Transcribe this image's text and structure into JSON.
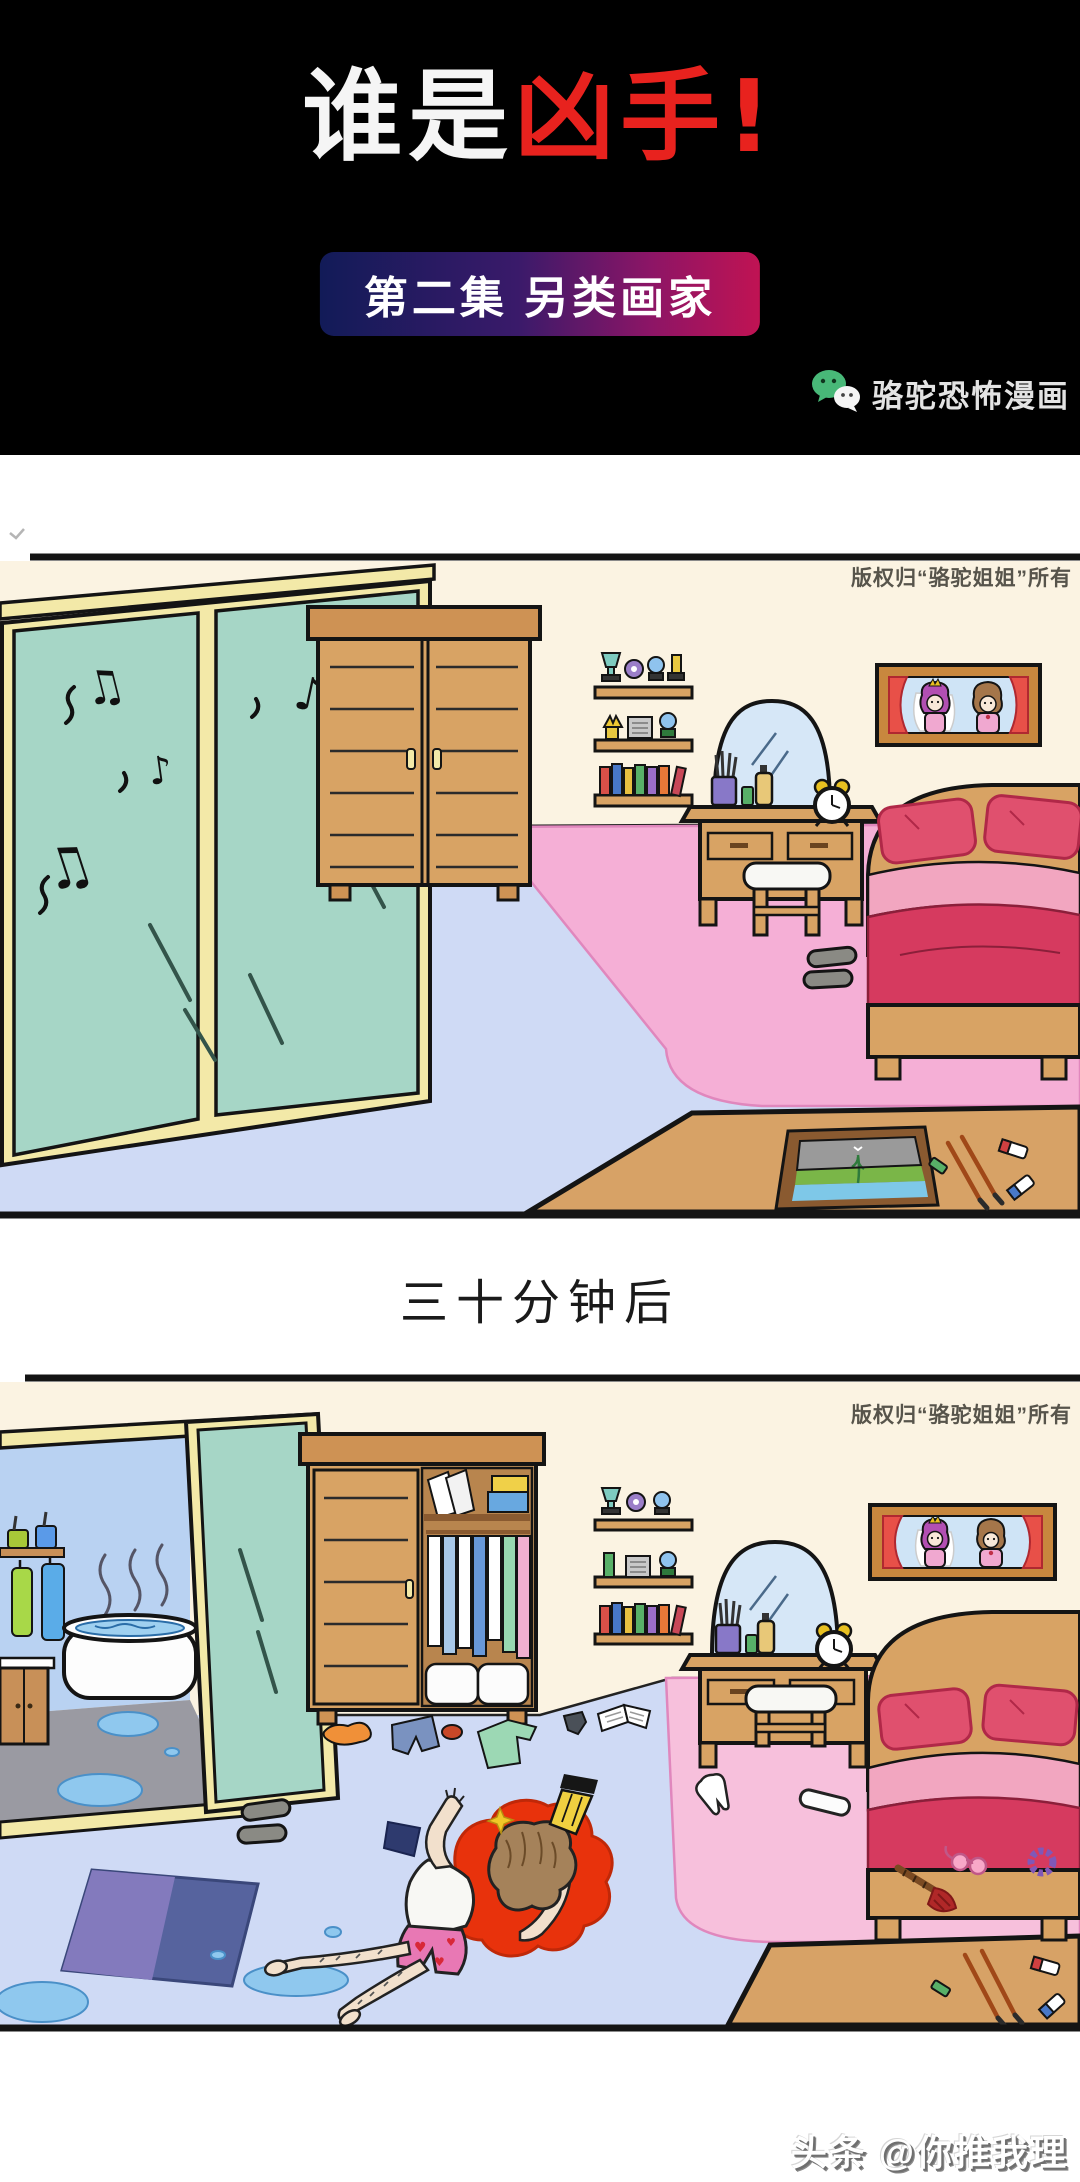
{
  "header": {
    "title": {
      "white_part": "谁是",
      "red_part": "凶手!"
    },
    "episode_banner": {
      "label": "第二集 另类画家"
    },
    "publisher": {
      "label": "骆驼恐怖漫画",
      "icon": "wechat-icon"
    },
    "colors": {
      "background": "#000000",
      "title_red": "#E8221E",
      "banner_gradient_start": "#121B58",
      "banner_gradient_end": "#C01353",
      "wechat_green": "#48B878"
    }
  },
  "panels": {
    "copyright": "版权归“骆驼姐姐”所有",
    "panel1_name": "bedroom-before",
    "panel2_name": "bedroom-thirty-minutes-later"
  },
  "divider": {
    "label": "三十分钟后"
  },
  "footer": {
    "watermark": "头条 @你推我理"
  },
  "icons": {
    "music_note_single": "♪",
    "music_note_beamed": "♫",
    "heart": "♥"
  },
  "scene_colors": {
    "wall": "#FBF3E2",
    "floor": "#CFDAF5",
    "glass_teal": "#A6D6C6",
    "frame_gold": "#F3E9A8",
    "wood": "#D8A364",
    "carpet_pink": "#F5AFD6",
    "blanket_red": "#D63A5F",
    "blood_red": "#E8320C",
    "rug_blue": "#56639E",
    "bath_wall_blue": "#B9D2F2",
    "bath_floor_gray": "#9A9AA2",
    "puddle_blue": "#8FC8EE"
  }
}
